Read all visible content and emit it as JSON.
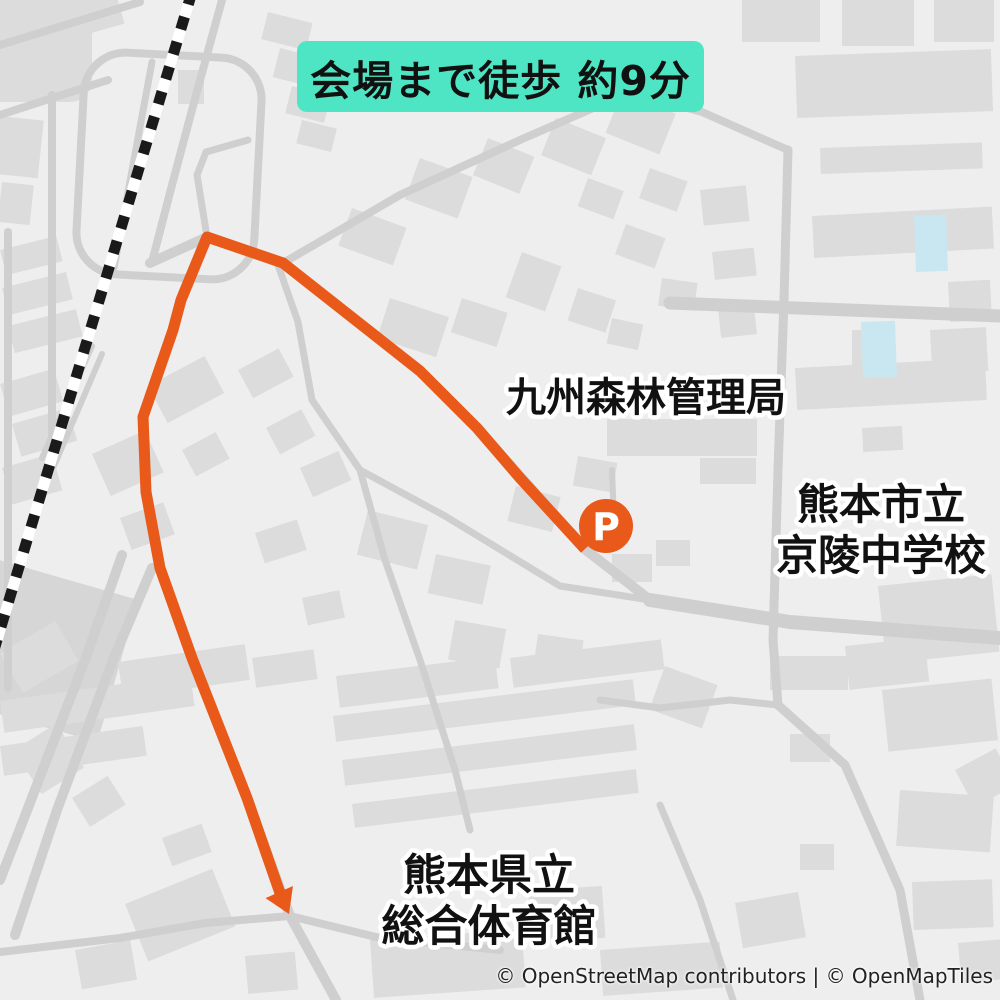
{
  "banner": {
    "text": "会場まで徒歩 約9分",
    "bg_color": "#4ee5c4",
    "text_color": "#111111"
  },
  "attribution": {
    "text": "© OpenStreetMap contributors | © OpenMapTiles"
  },
  "map": {
    "colors": {
      "background": "#eeeeee",
      "building": "#dcdcdc",
      "road": "#cfcfcf",
      "railway_dash": "#1a1a1a",
      "railway_base": "#ffffff",
      "route_orange": "#e8591a",
      "pool_blue": "#c9e7f1",
      "label_text": "#111111",
      "label_halo": "#ffffff"
    },
    "labels": [
      {
        "id": "kyushu-forest-bureau",
        "size": 40,
        "lines": [
          {
            "text": "九州森林管理局",
            "x": 646,
            "y": 411
          }
        ]
      },
      {
        "id": "keiryo-junior-high-school",
        "size": 42,
        "lines": [
          {
            "text": "熊本市立",
            "x": 881,
            "y": 519
          },
          {
            "text": "京陵中学校",
            "x": 881,
            "y": 570
          }
        ]
      },
      {
        "id": "prefectural-gymnasium",
        "size": 43,
        "lines": [
          {
            "text": "熊本県立",
            "x": 489,
            "y": 890
          },
          {
            "text": "総合体育館",
            "x": 489,
            "y": 941
          }
        ]
      }
    ],
    "parking_marker": {
      "label": "P",
      "x": 606,
      "y": 526,
      "r": 27,
      "color": "#e8591a",
      "label_color": "#ffffff"
    },
    "route": {
      "color": "#e8591a",
      "width": 11,
      "points": [
        [
          585,
          549
        ],
        [
          520,
          478
        ],
        [
          477,
          428
        ],
        [
          420,
          371
        ],
        [
          283,
          263
        ],
        [
          207,
          237
        ],
        [
          181,
          300
        ],
        [
          173,
          330
        ],
        [
          143,
          417
        ],
        [
          146,
          492
        ],
        [
          160,
          568
        ],
        [
          192,
          658
        ],
        [
          247,
          798
        ],
        [
          281,
          896
        ]
      ],
      "arrow_tip": [
        289,
        914
      ]
    }
  }
}
